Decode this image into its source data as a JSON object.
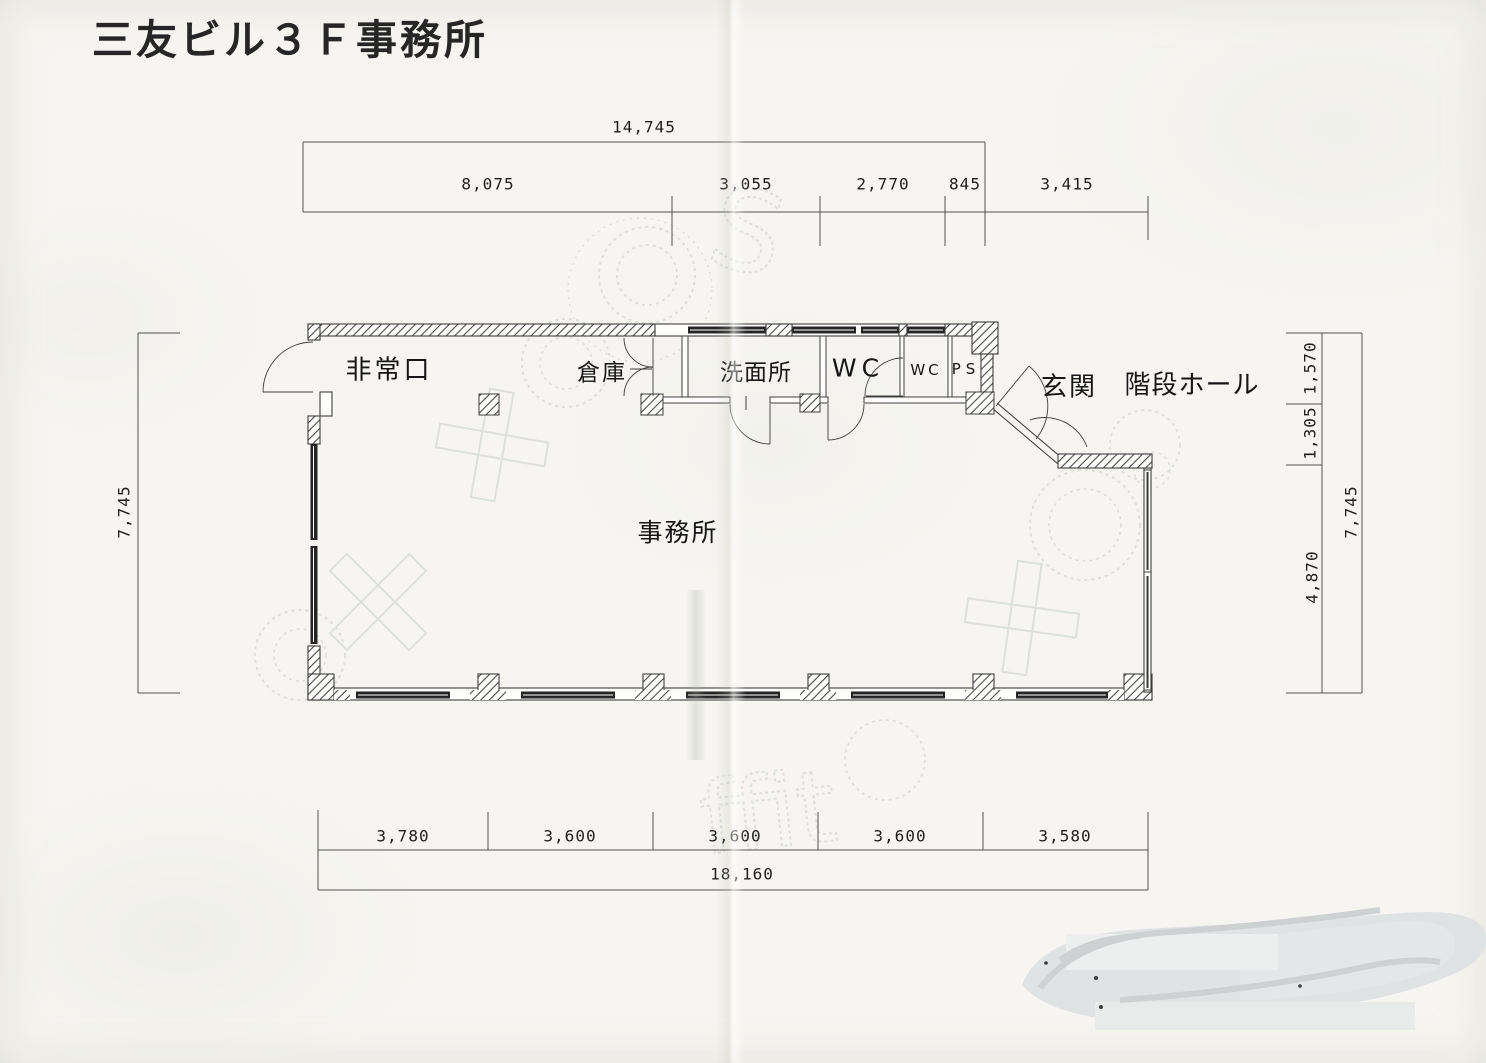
{
  "title": "三友ビル３Ｆ事務所",
  "rooms": {
    "emergency_exit": "非常口",
    "storage": "倉庫",
    "washroom": "洗面所",
    "wc": "WC",
    "wc_small": "WC",
    "pipe_shaft": "PS",
    "entrance": "玄関",
    "stair_hall": "階段ホール",
    "office": "事務所"
  },
  "dimensions": {
    "top": {
      "total": "14,745",
      "segments": [
        "8,075",
        "3,055",
        "2,770",
        "845",
        "3,415"
      ]
    },
    "bottom": {
      "segments": [
        "3,780",
        "3,600",
        "3,600",
        "3,600",
        "3,580"
      ],
      "total": "18,160"
    },
    "left": {
      "total": "7,745"
    },
    "right": {
      "segments": [
        "1,570",
        "1,305",
        "4,870"
      ],
      "total": "7,745"
    }
  },
  "watermark": {
    "letter_s": "S",
    "letter_f": "ffit"
  }
}
